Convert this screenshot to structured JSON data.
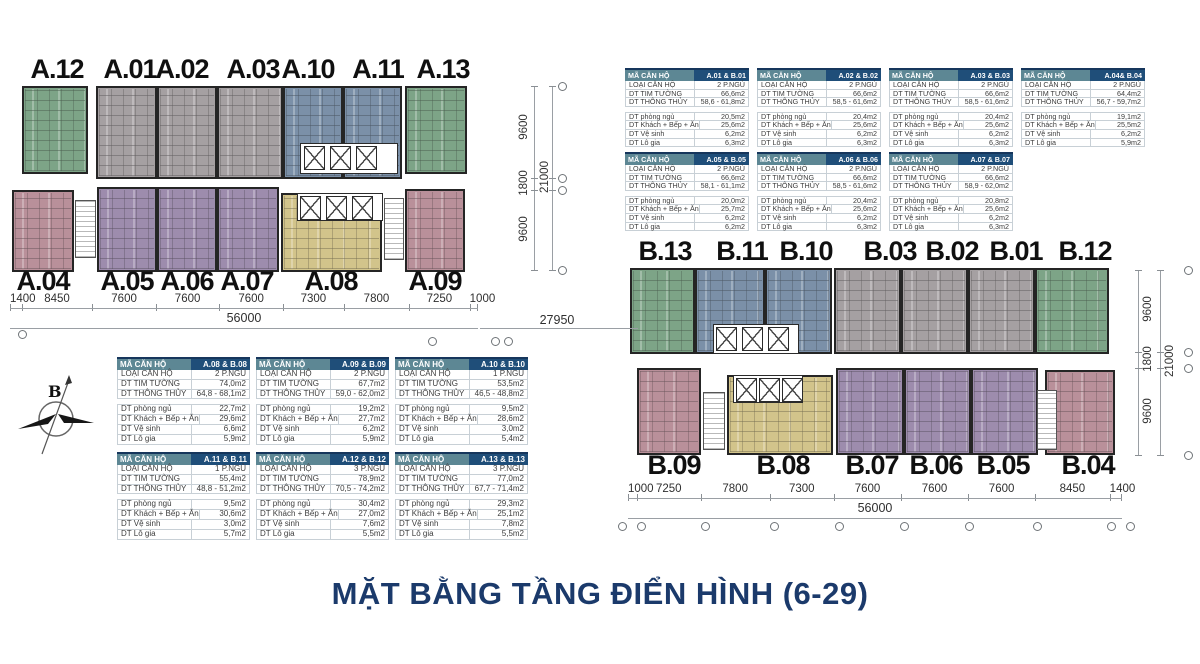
{
  "title": "MẶT BẰNG TẦNG ĐIỂN HÌNH (6-29)",
  "compass": {
    "label": "B"
  },
  "gap_dim": "27950",
  "colors": {
    "green": "#7da487",
    "gray": "#a5a0a2",
    "blue": "#7b90a8",
    "purple": "#9d8cad",
    "pink": "#b9909a",
    "yellow": "#d2c48b",
    "title_navy": "#1b3a6b",
    "table_header_teal": "#5d8794",
    "table_header_navy": "#1f4e79"
  },
  "legend": {
    "header_label": "MÃ CĂN HỘ",
    "spec_labels": [
      "LOẠI CĂN HỘ",
      "DT TIM TƯỜNG",
      "DT THÔNG THỦY"
    ],
    "detail_labels": [
      "DT phòng ngủ",
      "DT Khách + Bếp + Ăn",
      "DT Vệ sinh",
      "DT Lô gia"
    ]
  },
  "building_a": {
    "top_units": [
      {
        "label": "A.12",
        "color": "green"
      },
      {
        "label": "A.01",
        "color": "gray"
      },
      {
        "label": "A.02",
        "color": "gray"
      },
      {
        "label": "A.03",
        "color": "gray"
      },
      {
        "label": "A.10",
        "color": "blue"
      },
      {
        "label": "A.11",
        "color": "blue"
      },
      {
        "label": "A.13",
        "color": "green"
      }
    ],
    "bottom_units": [
      {
        "label": "A.04",
        "color": "pink"
      },
      {
        "label": "A.05",
        "color": "purple"
      },
      {
        "label": "A.06",
        "color": "purple"
      },
      {
        "label": "A.07",
        "color": "purple"
      },
      {
        "label": "A.08",
        "color": "yellow"
      },
      {
        "label": "A.09",
        "color": "pink"
      }
    ],
    "dims_bottom": [
      "1400",
      "8450",
      "7600",
      "7600",
      "7600",
      "7300",
      "7800",
      "7250",
      "1000"
    ],
    "dim_total": "56000",
    "dims_right": [
      "9600",
      "1800",
      "9600"
    ],
    "dim_right_total": "21000"
  },
  "building_b": {
    "top_units": [
      {
        "label": "B.13",
        "color": "green"
      },
      {
        "label": "B.11",
        "color": "blue"
      },
      {
        "label": "B.10",
        "color": "blue"
      },
      {
        "label": "B.03",
        "color": "gray"
      },
      {
        "label": "B.02",
        "color": "gray"
      },
      {
        "label": "B.01",
        "color": "gray"
      },
      {
        "label": "B.12",
        "color": "green"
      }
    ],
    "bottom_units": [
      {
        "label": "B.09",
        "color": "pink"
      },
      {
        "label": "B.08",
        "color": "yellow"
      },
      {
        "label": "B.07",
        "color": "purple"
      },
      {
        "label": "B.06",
        "color": "purple"
      },
      {
        "label": "B.05",
        "color": "purple"
      },
      {
        "label": "B.04",
        "color": "pink"
      }
    ],
    "dims_bottom": [
      "1000",
      "7250",
      "7800",
      "7300",
      "7600",
      "7600",
      "7600",
      "8450",
      "1400"
    ],
    "dim_total": "56000",
    "dims_right": [
      "9600",
      "1800",
      "9600"
    ],
    "dim_right_total": "21000"
  },
  "tables": [
    {
      "id": "A.01 & B.01",
      "loai": "2 P.NGỦ",
      "tim_tuong": "66,6m2",
      "thong_thuy": "58,6 - 61,8m2",
      "phong_ngu": "20,5m2",
      "khach_bep_an": "25,6m2",
      "ve_sinh": "6,2m2",
      "lo_gia": "6,3m2"
    },
    {
      "id": "A.02 & B.02",
      "loai": "2 P.NGỦ",
      "tim_tuong": "66,6m2",
      "thong_thuy": "58,5 - 61,6m2",
      "phong_ngu": "20,4m2",
      "khach_bep_an": "25,6m2",
      "ve_sinh": "6,2m2",
      "lo_gia": "6,3m2"
    },
    {
      "id": "A.03 & B.03",
      "loai": "2 P.NGỦ",
      "tim_tuong": "66,6m2",
      "thong_thuy": "58,5 - 61,6m2",
      "phong_ngu": "20,4m2",
      "khach_bep_an": "25,6m2",
      "ve_sinh": "6,2m2",
      "lo_gia": "6,3m2"
    },
    {
      "id": "A.04& B.04",
      "loai": "2 P.NGỦ",
      "tim_tuong": "64,4m2",
      "thong_thuy": "56,7 - 59,7m2",
      "phong_ngu": "19,1m2",
      "khach_bep_an": "25,5m2",
      "ve_sinh": "6,2m2",
      "lo_gia": "5,9m2"
    },
    {
      "id": "A.05 & B.05",
      "loai": "2 P.NGỦ",
      "tim_tuong": "66,6m2",
      "thong_thuy": "58,1 - 61,1m2",
      "phong_ngu": "20,0m2",
      "khach_bep_an": "25,7m2",
      "ve_sinh": "6,2m2",
      "lo_gia": "6,2m2"
    },
    {
      "id": "A.06 & B.06",
      "loai": "2 P.NGỦ",
      "tim_tuong": "66,6m2",
      "thong_thuy": "58,5 - 61,6m2",
      "phong_ngu": "20,4m2",
      "khach_bep_an": "25,6m2",
      "ve_sinh": "6,2m2",
      "lo_gia": "6,3m2"
    },
    {
      "id": "A.07 & B.07",
      "loai": "2 P.NGỦ",
      "tim_tuong": "66,6m2",
      "thong_thuy": "58,9 - 62,0m2",
      "phong_ngu": "20,8m2",
      "khach_bep_an": "25,6m2",
      "ve_sinh": "6,2m2",
      "lo_gia": "6,3m2"
    },
    {
      "id": "A.08 & B.08",
      "loai": "2 P.NGỦ",
      "tim_tuong": "74,0m2",
      "thong_thuy": "64,8 - 68,1m2",
      "phong_ngu": "22,7m2",
      "khach_bep_an": "29,6m2",
      "ve_sinh": "6,6m2",
      "lo_gia": "5,9m2"
    },
    {
      "id": "A.09 & B.09",
      "loai": "2 P.NGỦ",
      "tim_tuong": "67,7m2",
      "thong_thuy": "59,0 - 62,0m2",
      "phong_ngu": "19,2m2",
      "khach_bep_an": "27,7m2",
      "ve_sinh": "6,2m2",
      "lo_gia": "5,9m2"
    },
    {
      "id": "A.10 & B.10",
      "loai": "1 P.NGỦ",
      "tim_tuong": "53,5m2",
      "thong_thuy": "46,5 - 48,8m2",
      "phong_ngu": "9,5m2",
      "khach_bep_an": "28,6m2",
      "ve_sinh": "3,0m2",
      "lo_gia": "5,4m2"
    },
    {
      "id": "A.11 & B.11",
      "loai": "1 P.NGỦ",
      "tim_tuong": "55,4m2",
      "thong_thuy": "48,8 - 51,2m2",
      "phong_ngu": "9,5m2",
      "khach_bep_an": "30,6m2",
      "ve_sinh": "3,0m2",
      "lo_gia": "5,7m2"
    },
    {
      "id": "A.12 & B.12",
      "loai": "3 P.NGỦ",
      "tim_tuong": "78,9m2",
      "thong_thuy": "70,5 - 74,2m2",
      "phong_ngu": "30,4m2",
      "khach_bep_an": "27,0m2",
      "ve_sinh": "7,6m2",
      "lo_gia": "5,5m2"
    },
    {
      "id": "A.13 & B.13",
      "loai": "3 P.NGỦ",
      "tim_tuong": "77,0m2",
      "thong_thuy": "67,7 - 71,4m2",
      "phong_ngu": "29,3m2",
      "khach_bep_an": "25,1m2",
      "ve_sinh": "7,8m2",
      "lo_gia": "5,5m2"
    }
  ]
}
